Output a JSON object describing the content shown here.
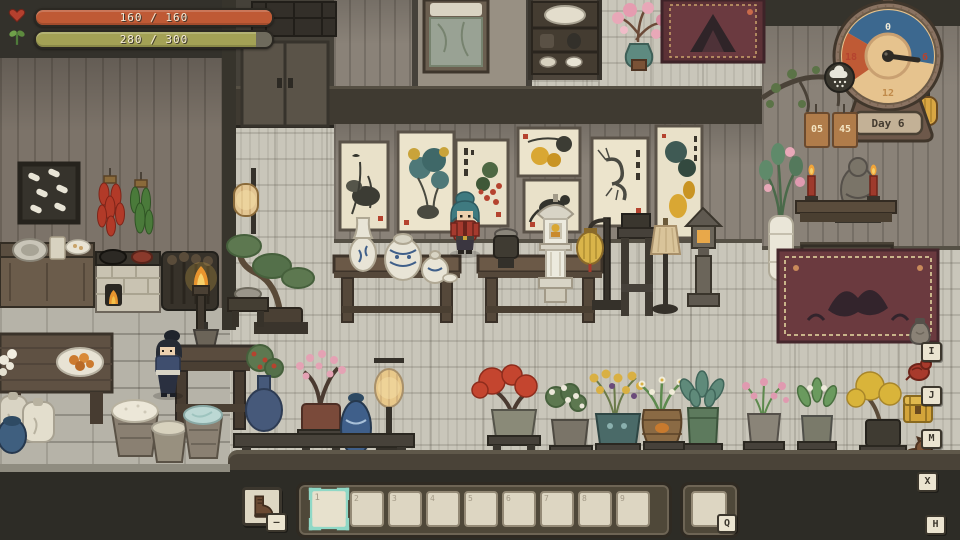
{
  "hud": {
    "health": {
      "label": "160 / 160",
      "icon": "heart-icon",
      "color": "#bf5a35"
    },
    "energy": {
      "label": "280 / 300",
      "icon": "sprout-icon",
      "color": "#a3a155",
      "fill_percent": 93.3
    }
  },
  "clock": {
    "dial_numbers": {
      "top": "0",
      "right": "6",
      "bottom": "12",
      "left": "18"
    },
    "day_label": "Day 6",
    "time_tags": [
      "05",
      "45"
    ],
    "weather_icon": "snow-cloud-icon",
    "night_color": "#3c688f",
    "dusk_color": "#bf5a35",
    "face_color": "#e6c38e"
  },
  "side_hotkeys": [
    {
      "key": "I",
      "icon": "money-pouch-icon"
    },
    {
      "key": "J",
      "icon": "red-bird-icon"
    },
    {
      "key": "M",
      "icon": "golden-chest-icon"
    },
    {
      "key": "X",
      "icon": "pet-icon"
    },
    {
      "key": "H",
      "icon": "handbook-icon"
    }
  ],
  "hotbar": {
    "boot_button": {
      "icon": "boot-icon",
      "key_hint": "–"
    },
    "slots": [
      "1",
      "2",
      "3",
      "4",
      "5",
      "6",
      "7",
      "8",
      "9"
    ],
    "selected_slot": "1",
    "quick_slot_key": "Q",
    "selection_color": "#8fd8c6"
  }
}
